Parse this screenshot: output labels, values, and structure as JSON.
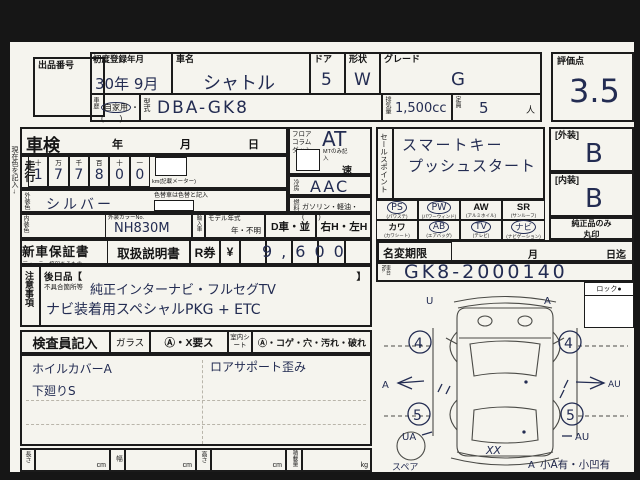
{
  "sheet": {
    "margin_note": "現在色を記入→",
    "auction_no_label": "出品番号",
    "first_reg_label": "初度登録年月",
    "first_reg_value": "30年 9月",
    "car_name_label": "車名",
    "car_name_value": "シャトル",
    "door_label": "ドア",
    "door_value": "5",
    "shape_label": "形状",
    "shape_value": "W",
    "grade_label": "グレード",
    "grade_value": "G",
    "history_label": "車歴",
    "history_value": "自家用",
    "history_suffix": "・(　　)",
    "model_label": "型式",
    "model_value": "DBA-GK8",
    "disp_label": "排気量",
    "disp_value": "1,500cc",
    "capacity_label": "定員",
    "capacity_value": "5",
    "capacity_unit": "人",
    "score_label": "評価点",
    "score_value": "3.5"
  },
  "shaken": {
    "label": "車検",
    "year": "年",
    "month": "月",
    "day": "日"
  },
  "mileage": {
    "label": "走行",
    "headers": [
      "十",
      "万",
      "千",
      "百",
      "十",
      "一"
    ],
    "digits": [
      "1",
      "7",
      "7",
      "8",
      "0",
      "0"
    ],
    "unit": "km(記載メーター)"
  },
  "ext_color": {
    "label": "外装色",
    "value": "シルバー",
    "note": "色替車は色替と記入"
  },
  "int_color": {
    "label": "内装色",
    "color_no_label": "外装カラーNo.",
    "color_no": "NH830M",
    "import_label": "輸入車",
    "model_year_label": "モデル年式",
    "model_year_value": "年・不明",
    "d_car": "D車・並",
    "handle": "右H・左H"
  },
  "trans": {
    "pos1": "フロア",
    "pos2": "コラム",
    "pos3": "ダッシュ",
    "value": "AT",
    "mt_note": "MTのみ記入",
    "speed": "速"
  },
  "ac": {
    "label": "冷房",
    "value": "AAC"
  },
  "fuel": {
    "label": "燃料",
    "value": "ガソリン・軽油・(　　)"
  },
  "warranty": {
    "booklet": "新車保証書",
    "booklet_note": "ディーラー捺印あるもの",
    "manual": "取扱説明書",
    "rticket": "R券",
    "yen": "¥",
    "price": "9,600"
  },
  "notes": {
    "label": "注意事項",
    "later": "後日品【",
    "later_close": "】",
    "defect": "不具合箇所等",
    "line1": "純正インターナビ・フルセグTV",
    "line2": "ナビ装着用スペシャルPKG + ETC"
  },
  "sales": {
    "label": "セールスポイント",
    "line1": "スマートキー",
    "line2": "プッシュスタート"
  },
  "equip": {
    "items": [
      {
        "code": "PS",
        "sub": "(パワステ)",
        "circled": true
      },
      {
        "code": "PW",
        "sub": "(パワーウィンド)",
        "circled": true
      },
      {
        "code": "AW",
        "sub": "(アルミホイル)",
        "circled": false
      },
      {
        "code": "SR",
        "sub": "(サンルーフ)",
        "circled": false
      },
      {
        "code": "カワ",
        "sub": "(カワシート)",
        "circled": false
      },
      {
        "code": "AB",
        "sub": "(エアバッグ)",
        "circled": true
      },
      {
        "code": "TV",
        "sub": "(テレビ)",
        "circled": true
      },
      {
        "code": "ナビ",
        "sub": "(ナビゲーション)",
        "circled": true
      }
    ]
  },
  "ratings": {
    "ext_label": "[外装]",
    "ext": "B",
    "int_label": "[内装]",
    "int": "B",
    "genuine1": "純正品のみ",
    "genuine2": "丸印"
  },
  "namechange": {
    "label": "名変期限",
    "month": "月",
    "until": "日迄"
  },
  "chassis": {
    "label": "車台No.",
    "value": "GK8-2000140"
  },
  "lock": {
    "label": "ロック●"
  },
  "inspector": {
    "label": "検査員記入",
    "glass": "ガラス",
    "glass_marks": "Ⓐ・X要ス",
    "seat": "室内シート",
    "seat_marks": "Ⓐ・コゲ・穴・汚れ・破れ",
    "note1": "ホイルカバーA",
    "note2": "下廻りS",
    "note3": "ロアサポート歪み"
  },
  "dims": {
    "length": "長さ",
    "width": "幅",
    "height": "高さ",
    "load": "積載量",
    "cm": "cm",
    "kg": "kg"
  },
  "diagram": {
    "spare": "スペア",
    "summary": "小A有・小凹有",
    "wheel_fl": "4",
    "wheel_fr": "4",
    "wheel_rl": "5",
    "wheel_rr": "5",
    "mark_front_l": "U",
    "mark_front_r": "A",
    "mark_left": "A",
    "mark_right": "AU",
    "mark_rl": "UA",
    "mark_rr": "AU",
    "mark_bottom": "XX",
    "mark_rear": "A"
  }
}
